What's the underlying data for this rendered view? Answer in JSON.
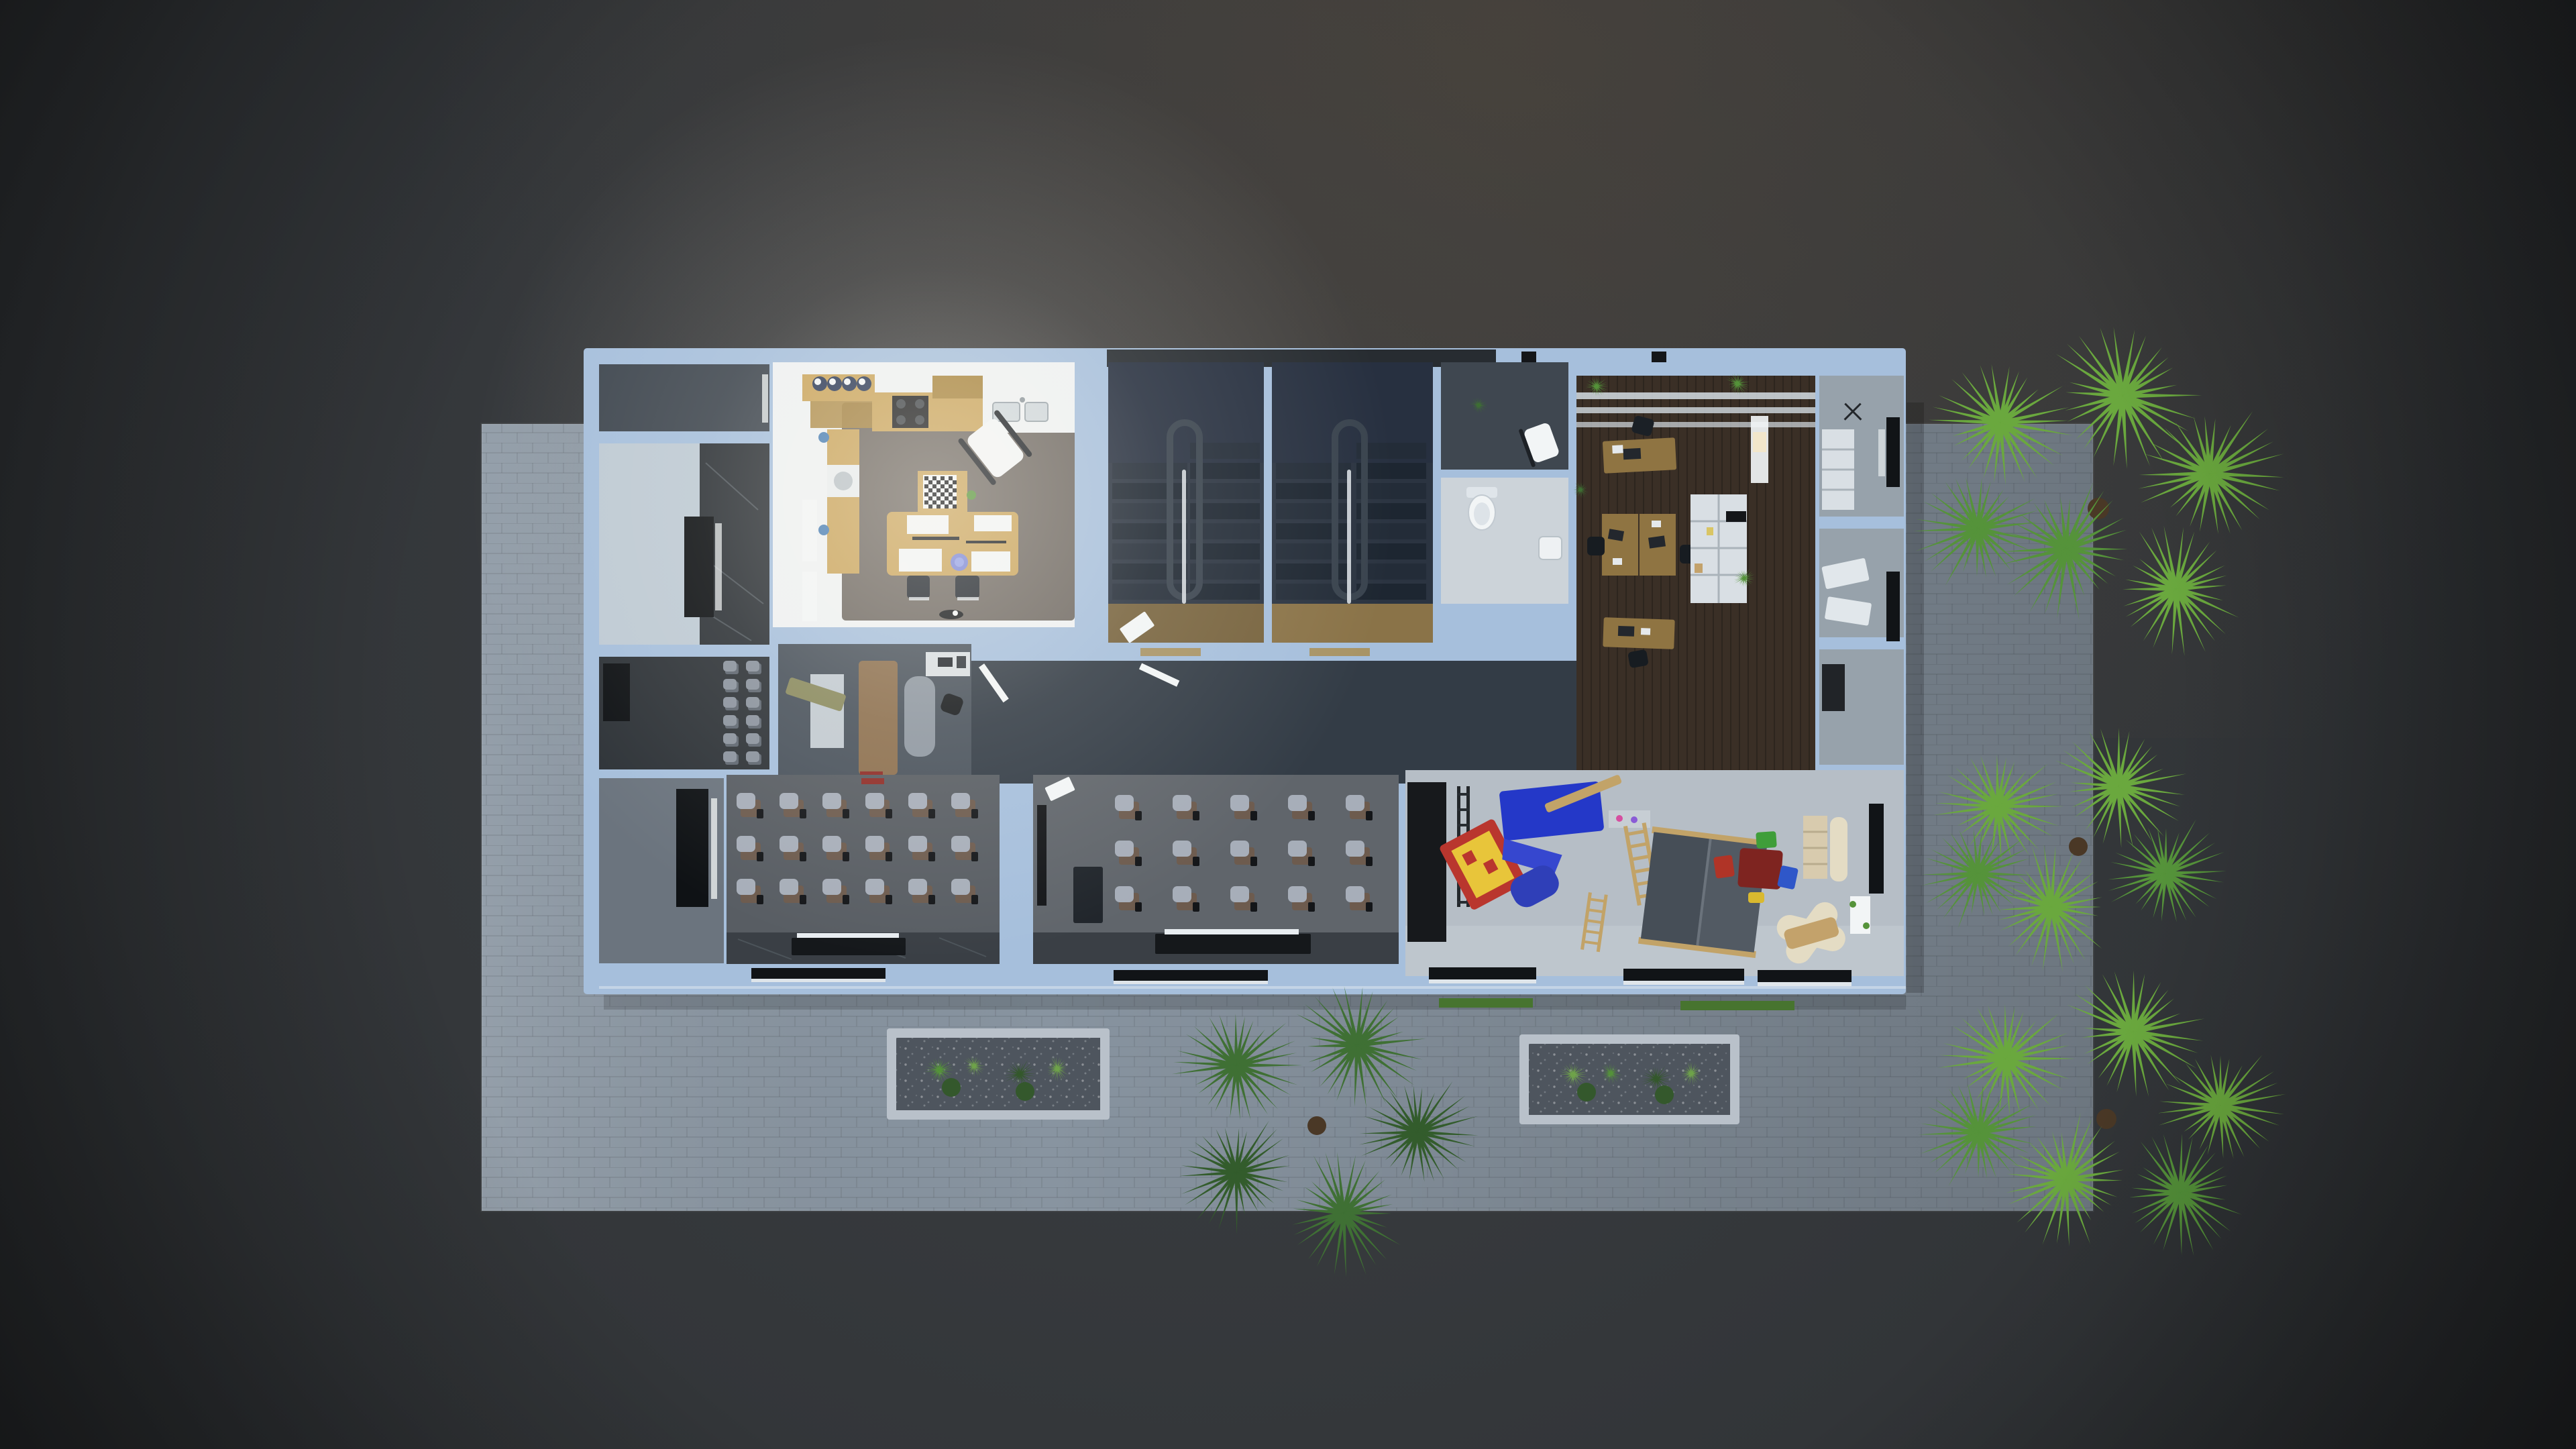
{
  "scene": {
    "type": "3d-floorplan-top-down-render",
    "time_of_day": "night",
    "description": "Top-down dollhouse render of a single building floor at night on dark asphalt with a light paver terrace, two gravel planters and four fan palm trees",
    "building": {
      "rooms": [
        {
          "id": "entry-room-north",
          "lit": false,
          "furniture": [
            "window"
          ]
        },
        {
          "id": "marble-lobby",
          "lit": false,
          "furniture": [
            "dark-marble-wall",
            "black-cabinet"
          ]
        },
        {
          "id": "waiting-corridor",
          "lit": false,
          "furniture": [
            "stacked-gray-chairs",
            "black-cabinet"
          ],
          "chair_columns": 2,
          "chair_rows": 6
        },
        {
          "id": "storage-room",
          "lit": false,
          "furniture": [
            "black-cabinet",
            "window-slit"
          ]
        },
        {
          "id": "kitchen-dining",
          "lit": true,
          "furniture": [
            "kitchen-island",
            "bar-stools",
            "gas-stove",
            "sink-counter",
            "upper-cabinet",
            "washing-machine",
            "radiator",
            "chess-table",
            "dining-table",
            "dining-chairs",
            "rocking-chair",
            "flower-vase",
            "pet-bowl"
          ],
          "bar_stools": 4
        },
        {
          "id": "stairwell-west",
          "lit": false,
          "furniture": [
            "u-stair",
            "handrail",
            "wood-landing",
            "dropped-paper"
          ]
        },
        {
          "id": "stairwell-east",
          "lit": false,
          "furniture": [
            "u-stair",
            "handrail",
            "wood-landing"
          ]
        },
        {
          "id": "wc-anteroom",
          "lit": false,
          "furniture": [
            "white-chair",
            "potted-plant"
          ]
        },
        {
          "id": "wc",
          "lit": false,
          "furniture": [
            "toilet",
            "washbasin"
          ]
        },
        {
          "id": "study-room",
          "lit": false,
          "furniture": [
            "bench",
            "daybed",
            "computer-desk",
            "office-chair",
            "rug",
            "red-toy"
          ]
        },
        {
          "id": "dark-hall",
          "lit": false,
          "furniture": [
            "open-door-leaves",
            "wood-thresholds"
          ]
        },
        {
          "id": "open-office",
          "lit": false,
          "furniture": [
            "pergola-beams",
            "desk",
            "double-desk",
            "desk",
            "laptops",
            "office-chairs",
            "bookshelf",
            "potted-palms",
            "lit-window"
          ],
          "desks": 4
        },
        {
          "id": "east-wing",
          "lit": false,
          "furniture": [
            "white-cabinet",
            "ceiling-fan",
            "casement-windows",
            "shuttered-windows",
            "black-chest"
          ]
        },
        {
          "id": "classroom-west",
          "lit": false,
          "chairs": {
            "rows": 3,
            "cols": 6
          },
          "furniture": [
            "tablet-arm-chairs",
            "teacher-desk",
            "light-strip",
            "black-cabinet",
            "marble-stage",
            "red-marker"
          ]
        },
        {
          "id": "classroom-east",
          "lit": false,
          "chairs": {
            "rows": 3,
            "cols": 5
          },
          "furniture": [
            "tablet-arm-chairs",
            "teacher-desk",
            "light-strip",
            "podium",
            "wall-board",
            "paper-sheet"
          ]
        },
        {
          "id": "kindergarten-playroom",
          "lit": false,
          "furniture": [
            "chalkboard",
            "wall-ladder",
            "blue-play-mat",
            "wood-beam",
            "toy-shelf",
            "playhouse-with-slide",
            "climbing-ladders",
            "wooden-playhouse",
            "kids-table",
            "kids-chairs",
            "cream-bookshelf",
            "reading-bench",
            "lounge-chair",
            "lit-window",
            "shuttered-window",
            "facade-windows"
          ]
        }
      ]
    },
    "outdoor": {
      "ground": "dark asphalt",
      "terrace": "light paver slab",
      "planters": 2,
      "palm_trees": [
        {
          "id": "palm-north-east",
          "shaded": false
        },
        {
          "id": "palm-east",
          "shaded": false
        },
        {
          "id": "palm-south-east",
          "shaded": false
        },
        {
          "id": "palm-south",
          "shaded": true
        }
      ]
    }
  },
  "colors": {
    "bg_center": "#3d4044",
    "bg_edge": "#222426",
    "paver": "#8894a0",
    "wall": "#a6bfdc",
    "roof_dark": "#272c31",
    "glass_white": "#f2f5f6",
    "window_black": "#111417",
    "hall_floor": "#333c46",
    "stair_floor": "#2b3441",
    "stair_land": "#273040",
    "tread_a": "#232c38",
    "tread_b": "#1d2631",
    "rail": "#39434e",
    "handrail": "#d7dde2",
    "wood_landing": "#77633e",
    "wood_landing2": "#8a7348",
    "kitchen_floor": "#6f6963",
    "kitchen_white": "#eef1f2",
    "wood": "#c9a45c",
    "wood_dark": "#a8853f",
    "stove": "#1c1d1f",
    "burner": "#3f4449",
    "navy": "#2c3a57",
    "marble_dark": "#2e3338",
    "marble_streak": "#707a80",
    "lobby_white": "#becad4",
    "room_dark": "#3f4750",
    "room_dim": "#6b747e",
    "cab_black": "#0f1215",
    "study_floor": "#49525c",
    "khaki": "#8a8a5f",
    "daybed": "#8c6f4e",
    "rug": "#9aa3ad",
    "wc_white": "#ccd3d9",
    "office_floor": "#3a2f26",
    "office_wood": "#8f7442",
    "laptop": "#23272d",
    "shelf_white": "#d9dfe4",
    "wing_floor": "#97a2ab",
    "class_floor": "#585d63",
    "class_floor2": "#60656b",
    "class_marble": "#3a3f45",
    "board_black": "#141619",
    "desk_black": "#15181b",
    "light_strip": "#e8edf1",
    "chair_seat": "#a7aeb9",
    "chair_back": "#6d5b4e",
    "chair_gray": "#8b939e",
    "chair_gray_dark": "#5f6771",
    "play_floor": "#b6bec6",
    "chalk": "#17191c",
    "mat_blue": "#2438c8",
    "slide_blue": "#3647cf",
    "house_red": "#b9362e",
    "house_yellow": "#e8c53a",
    "toy_roof_l": "#464e57",
    "toy_roof_r": "#525a63",
    "toy_wood": "#c2a368",
    "table_red": "#7e2420",
    "chair_red": "#b03427",
    "chair_blue": "#2f57c9",
    "chair_green": "#3f9e3a",
    "chair_yellow": "#d9b92f",
    "cream": "#d8cbae",
    "cream_light": "#e4dcc4",
    "tan": "#c3a26b",
    "planter_frame": "#b9c1ca",
    "gravel": "#4e555e",
    "plant_green2": "#6fa34a",
    "plant_dark": "#34582c",
    "palm_bright": "#6aa83e",
    "palm_mid": "#55933a",
    "palm_dark": "#3f7034",
    "palm_shadow": "#335c2c",
    "trunk": "#4a3826",
    "grass": "#47742f",
    "red_obj": "#8e2b26",
    "blue_dot": "#4a7fb5",
    "vase_blue": "#7b86d6",
    "white_soft": "#dfe5ea"
  }
}
